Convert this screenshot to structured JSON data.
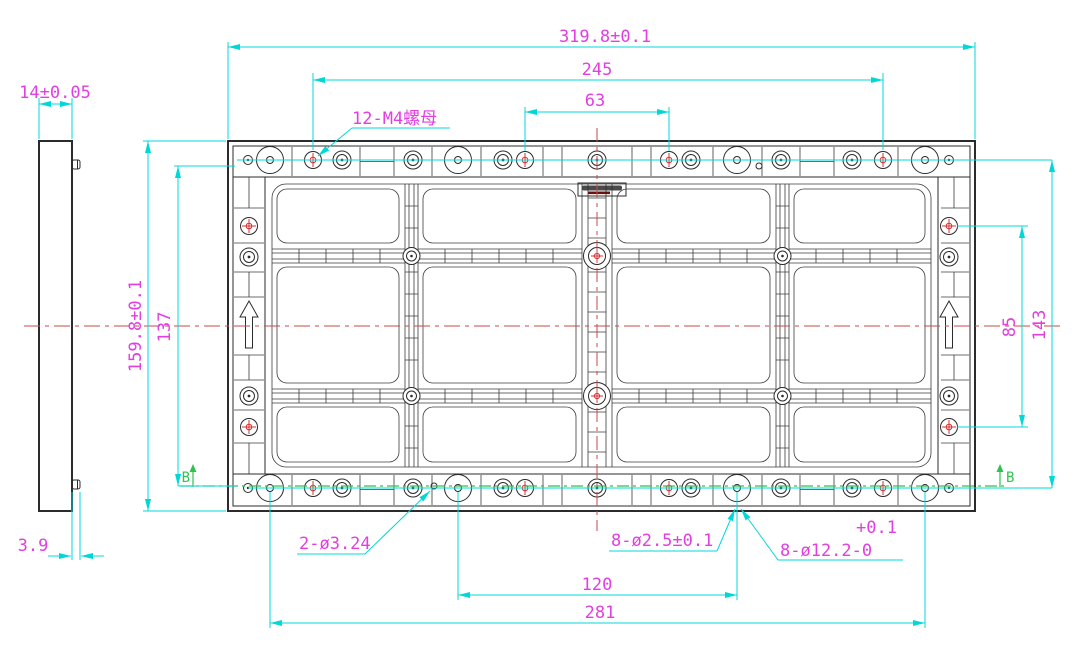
{
  "dimensions": {
    "overall_width": "319.8±0.1",
    "bolt_span_width": "245",
    "center_hole_span": "63",
    "overall_height": "159.8±0.1",
    "inner_height": "137",
    "side_hole_span": "85",
    "side_outer_span": "143",
    "panel_thickness": "14±0.05",
    "stud_protrusion": "3.9",
    "bottom_inner_span": "120",
    "bottom_outer_span": "281"
  },
  "labels": {
    "m4_nuts": "12-M4螺母",
    "small_holes": "2-ø3.24",
    "pin_holes": "8-ø2.5±0.1",
    "counterbore_tol_plus": "+0.1",
    "counterbore": "8-ø12.2-0"
  },
  "section": {
    "marker": "B"
  },
  "colors": {
    "dimension_line": "#00d8d8",
    "dimension_text": "#e23ee2",
    "centerline": "#c84a4a",
    "section_line": "#2fc24f",
    "drawing_line": "#2b2b2b",
    "background": "#ffffff"
  }
}
